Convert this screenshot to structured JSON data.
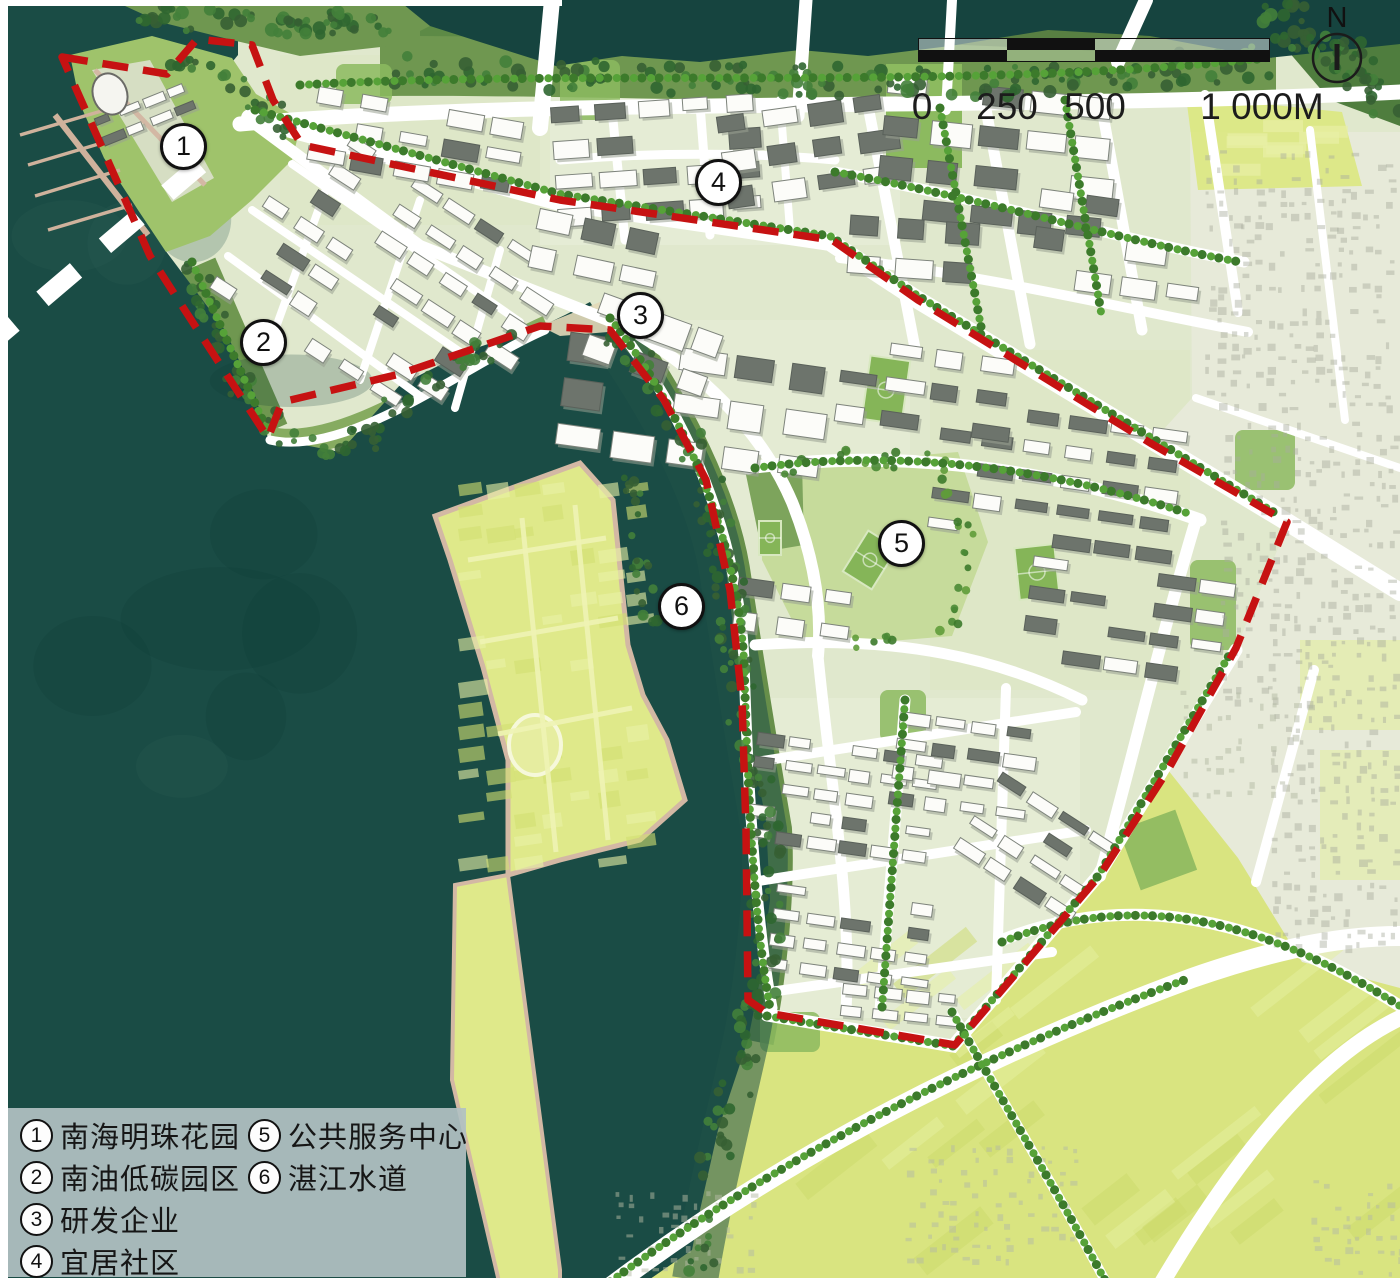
{
  "map": {
    "region_markers": [
      {
        "number": "1",
        "name": "南海明珠花园",
        "x": 181,
        "y": 144
      },
      {
        "number": "2",
        "name": "南油低碳园区",
        "x": 261,
        "y": 340
      },
      {
        "number": "3",
        "name": "研发企业",
        "x": 638,
        "y": 313
      },
      {
        "number": "4",
        "name": "宜居社区",
        "x": 716,
        "y": 180
      },
      {
        "number": "5",
        "name": "公共服务中心",
        "x": 899,
        "y": 541
      },
      {
        "number": "6",
        "name": "湛江水道",
        "x": 679,
        "y": 604
      }
    ],
    "legend": {
      "columns": [
        {
          "items": [
            {
              "number": "1",
              "label": "南海明珠花园"
            },
            {
              "number": "2",
              "label": "南油低碳园区"
            },
            {
              "number": "3",
              "label": "研发企业"
            },
            {
              "number": "4",
              "label": "宜居社区"
            }
          ]
        },
        {
          "items": [
            {
              "number": "5",
              "label": "公共服务中心"
            },
            {
              "number": "6",
              "label": "湛江水道"
            }
          ]
        }
      ]
    },
    "scale_bar": {
      "labels": [
        "0",
        "250",
        "500",
        "1 000M"
      ]
    },
    "north_arrow_label": "N",
    "colors": {
      "sea": "#1a4c45",
      "channel": "#215247",
      "boundary_red": "#c61212",
      "farmland_yellow": "#dfe98a",
      "urban_base": "#e0e8cd",
      "road_white": "#ffffff",
      "tree_green": "#3c7a2b"
    }
  }
}
